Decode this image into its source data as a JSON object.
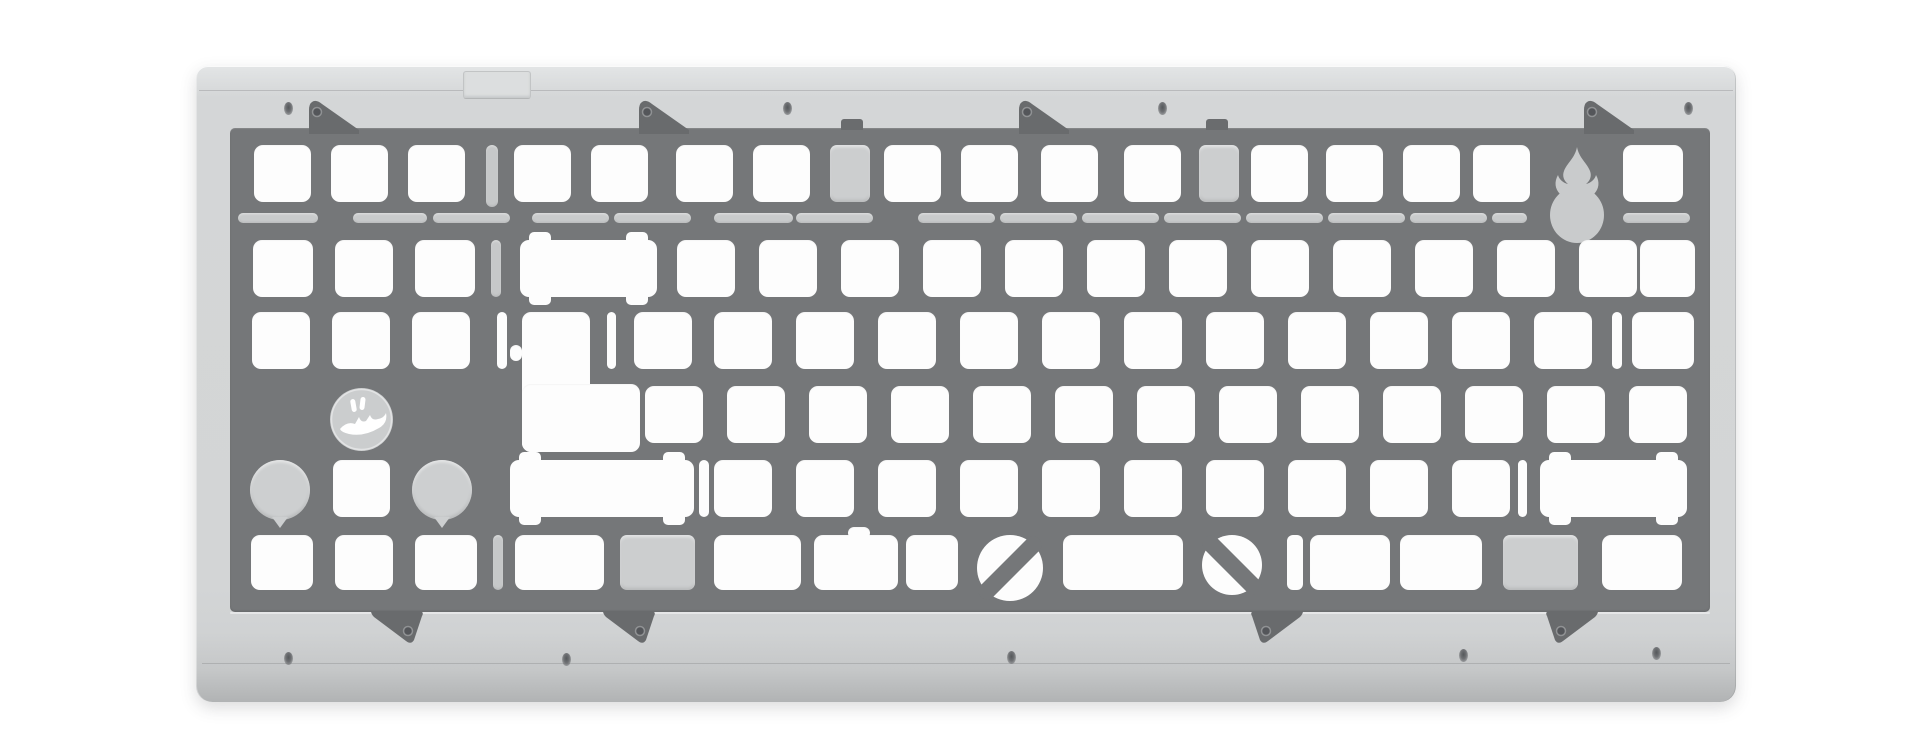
{
  "meta": {
    "title": "Mechanical keyboard switch plate render — silver case, gray plate, flame and mascot engravings"
  },
  "colors": {
    "background": "#ffffff",
    "case_face": "#d3d5d6",
    "case_top_highlight": "#e3e5e6",
    "case_bottom_edge": "#b1b3b4",
    "plate": "#757779",
    "plate_tab": "#696b6d",
    "cutout": "#fdfdfd",
    "recessed_slot": "#c6c8c9",
    "recessed_pocket": "#cccecf",
    "engraving": "#c9cbcc",
    "screw_hole": "#55585b"
  },
  "stage": {
    "w": 1920,
    "h": 737
  },
  "case_geom": {
    "x": 196,
    "y": 66,
    "w": 1540,
    "h": 636
  },
  "plate_geom": {
    "x": 230,
    "y": 128,
    "w": 1480,
    "h": 484
  },
  "icons": [
    "flame-icon",
    "mascot-badge-icon",
    "screw-hole-icon",
    "mounting-tab-icon"
  ],
  "decorations": {
    "usb_notch": {
      "x": 463,
      "y": 71,
      "w": 66,
      "h": 26
    },
    "tabs_top": [
      {
        "x": 306
      },
      {
        "x": 636
      },
      {
        "x": 1016
      },
      {
        "x": 1581
      }
    ],
    "tabs_top_y": 100,
    "tabs_bottom": [
      {
        "x": 368,
        "dir": "r"
      },
      {
        "x": 600,
        "dir": "r"
      },
      {
        "x": 1250,
        "dir": "l"
      },
      {
        "x": 1545,
        "dir": "l"
      }
    ],
    "tabs_bottom_y": 611,
    "tab_size": {
      "w": 56,
      "h": 34
    },
    "hooks": [
      {
        "x": 841
      },
      {
        "x": 1206
      }
    ],
    "hook_geom": {
      "y": 119,
      "w": 22,
      "h": 11
    },
    "screws_top": [
      [
        284,
        102
      ],
      [
        783,
        102
      ],
      [
        1158,
        102
      ],
      [
        1684,
        102
      ]
    ],
    "screws_bottom": [
      [
        284,
        652
      ],
      [
        562,
        653
      ],
      [
        1007,
        651
      ],
      [
        1459,
        649
      ],
      [
        1652,
        647
      ]
    ]
  },
  "flex_cuts": {
    "y": 213,
    "h": 10,
    "segs": [
      [
        238,
        80
      ],
      [
        353,
        74
      ],
      [
        433,
        77
      ],
      [
        532,
        77
      ],
      [
        614,
        77
      ],
      [
        714,
        79
      ],
      [
        796,
        77
      ],
      [
        918,
        77
      ],
      [
        1000,
        77
      ],
      [
        1082,
        77
      ],
      [
        1164,
        77
      ],
      [
        1246,
        77
      ],
      [
        1328,
        77
      ],
      [
        1410,
        77
      ],
      [
        1492,
        35
      ],
      [
        1623,
        67
      ]
    ]
  },
  "rows": [
    {
      "y": 145,
      "h": 57,
      "kw": 57,
      "items": [
        {
          "x": 254
        },
        {
          "x": 331
        },
        {
          "x": 408
        },
        {
          "x": 486,
          "w": 12,
          "h": 62,
          "t": "rslot"
        },
        {
          "x": 514
        },
        {
          "x": 591
        },
        {
          "x": 676
        },
        {
          "x": 753
        },
        {
          "x": 830,
          "w": 40,
          "t": "pocket"
        },
        {
          "x": 884
        },
        {
          "x": 961
        },
        {
          "x": 1041
        },
        {
          "x": 1124
        },
        {
          "x": 1199,
          "w": 40,
          "t": "pocket"
        },
        {
          "x": 1251
        },
        {
          "x": 1326
        },
        {
          "x": 1403
        },
        {
          "x": 1473
        },
        {
          "x": 1548,
          "w": 58,
          "h": 100,
          "t": "flame"
        },
        {
          "x": 1623,
          "w": 60
        }
      ]
    },
    {
      "y": 240,
      "h": 57,
      "kw": 58,
      "items": [
        {
          "x": 253,
          "w": 60
        },
        {
          "x": 335
        },
        {
          "x": 415,
          "w": 60
        },
        {
          "x": 491,
          "w": 10,
          "t": "rslot"
        },
        {
          "x": 520,
          "w": 137,
          "t": "stab"
        },
        {
          "x": 677
        },
        {
          "x": 759
        },
        {
          "x": 841
        },
        {
          "x": 923
        },
        {
          "x": 1005
        },
        {
          "x": 1087
        },
        {
          "x": 1169
        },
        {
          "x": 1251
        },
        {
          "x": 1333
        },
        {
          "x": 1415
        },
        {
          "x": 1497
        },
        {
          "x": 1579
        },
        {
          "x": 1640,
          "w": 55
        }
      ]
    },
    {
      "y": 312,
      "h": 57,
      "kw": 58,
      "items": [
        {
          "x": 252
        },
        {
          "x": 332
        },
        {
          "x": 412
        },
        {
          "x": 497,
          "w": 10,
          "t": "wslot"
        },
        {
          "t": "multi",
          "rects": [
            [
              522,
              312,
              68,
              140
            ],
            [
              522,
              384,
              118,
              68
            ],
            [
              510,
              345,
              12,
              16
            ]
          ]
        },
        {
          "x": 607,
          "w": 9,
          "t": "wslot"
        },
        {
          "x": 634
        },
        {
          "x": 714
        },
        {
          "x": 796
        },
        {
          "x": 878
        },
        {
          "x": 960
        },
        {
          "x": 1042
        },
        {
          "x": 1124
        },
        {
          "x": 1206
        },
        {
          "x": 1288
        },
        {
          "x": 1370
        },
        {
          "x": 1452
        },
        {
          "x": 1534
        },
        {
          "x": 1612,
          "w": 10,
          "t": "wslot"
        },
        {
          "x": 1632,
          "w": 62
        }
      ]
    },
    {
      "y": 386,
      "h": 57,
      "kw": 58,
      "items": [
        {
          "t": "badge",
          "x": 330,
          "y": 388,
          "w": 63,
          "h": 63
        },
        {
          "x": 645
        },
        {
          "x": 727
        },
        {
          "x": 809
        },
        {
          "x": 891
        },
        {
          "x": 973
        },
        {
          "x": 1055
        },
        {
          "x": 1137
        },
        {
          "x": 1219
        },
        {
          "x": 1301
        },
        {
          "x": 1383
        },
        {
          "x": 1465
        },
        {
          "x": 1547
        },
        {
          "x": 1629
        }
      ]
    },
    {
      "y": 460,
      "h": 57,
      "kw": 58,
      "items": [
        {
          "t": "tearcircle",
          "x": 250,
          "w": 60
        },
        {
          "x": 333,
          "w": 57
        },
        {
          "t": "tearcircle",
          "x": 412,
          "w": 60
        },
        {
          "x": 510,
          "w": 184,
          "t": "stab"
        },
        {
          "x": 699,
          "w": 10,
          "t": "wslot"
        },
        {
          "x": 714
        },
        {
          "x": 796
        },
        {
          "x": 878
        },
        {
          "x": 960
        },
        {
          "x": 1042
        },
        {
          "x": 1124
        },
        {
          "x": 1206
        },
        {
          "x": 1288
        },
        {
          "x": 1370
        },
        {
          "x": 1452
        },
        {
          "x": 1518,
          "w": 9,
          "t": "wslot"
        },
        {
          "x": 1540,
          "w": 147,
          "t": "stab"
        }
      ]
    },
    {
      "y": 535,
      "h": 55,
      "kw": 58,
      "items": [
        {
          "x": 251,
          "w": 62
        },
        {
          "x": 335
        },
        {
          "x": 415,
          "w": 62
        },
        {
          "x": 493,
          "w": 10,
          "t": "rslot"
        },
        {
          "x": 515,
          "w": 89
        },
        {
          "x": 620,
          "w": 75,
          "t": "pocket"
        },
        {
          "x": 714,
          "w": 87
        },
        {
          "x": 814,
          "w": 84
        },
        {
          "x": 848,
          "y": 527,
          "w": 22,
          "h": 12
        },
        {
          "x": 906,
          "w": 52
        },
        {
          "t": "diagl",
          "x": 977,
          "w": 66
        },
        {
          "x": 1063,
          "w": 120
        },
        {
          "t": "diagr",
          "x": 1202,
          "w": 60
        },
        {
          "x": 1287,
          "w": 16,
          "t": "wslot"
        },
        {
          "x": 1310,
          "w": 80
        },
        {
          "x": 1400,
          "w": 82
        },
        {
          "x": 1503,
          "w": 75,
          "t": "pocket"
        },
        {
          "x": 1602,
          "w": 80
        }
      ]
    }
  ]
}
